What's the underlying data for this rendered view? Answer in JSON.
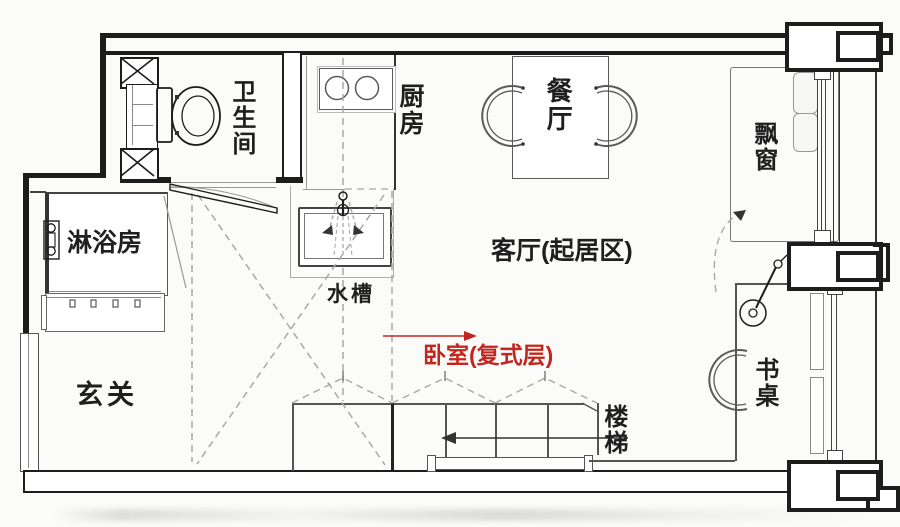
{
  "colors": {
    "background": "#fbfbfa",
    "ink": "#1d1d1d",
    "furniture": "#5a5a5a",
    "light": "#9a9a9a",
    "dashed": "#a8a8a8",
    "red": "#c2271f"
  },
  "rooms": {
    "bathroom": {
      "label": "卫生间"
    },
    "kitchen": {
      "label": "厨房"
    },
    "dining": {
      "label": "餐厅"
    },
    "bay_window": {
      "label": "飘窗"
    },
    "shower": {
      "label": "淋浴房"
    },
    "sink": {
      "label": "水槽"
    },
    "living": {
      "label": "客厅(起居区)"
    },
    "bedroom_loft": {
      "label": "卧室(复式层)",
      "color": "#c2271f"
    },
    "entry": {
      "label": "玄关"
    },
    "desk": {
      "label": "书桌"
    },
    "stairs": {
      "label": "楼梯"
    }
  },
  "annotations": {
    "bedroom_arrow_direction": "right",
    "stairs_arrow_direction": "left"
  }
}
